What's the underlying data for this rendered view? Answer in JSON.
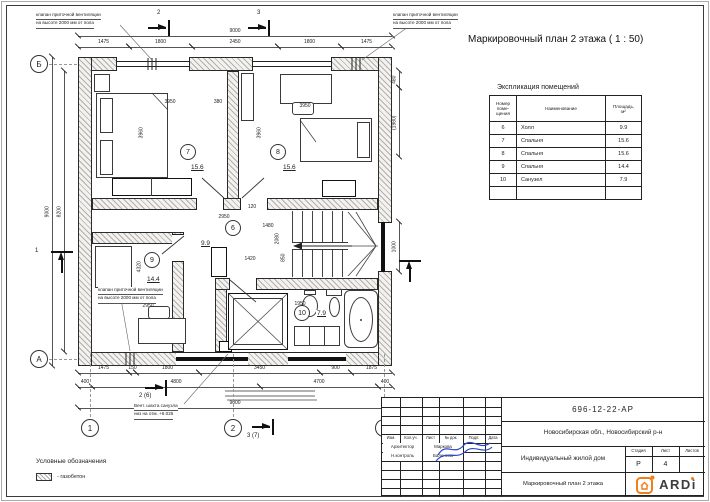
{
  "plan_title": "Маркировочный план 2 этажа ( 1 : 50)",
  "exp_table": {
    "title": "Экспликация помещений",
    "headers": [
      "Номер\nпоме-\nщения",
      "Наименование",
      "Площадь,\nм²"
    ],
    "rows": [
      [
        "6",
        "Холл",
        "9.9"
      ],
      [
        "7",
        "Спальня",
        "15.6"
      ],
      [
        "8",
        "Спальня",
        "15.6"
      ],
      [
        "9",
        "Спальня",
        "14.4"
      ],
      [
        "10",
        "Санузел",
        "7.9"
      ],
      [
        "",
        "",
        ""
      ]
    ]
  },
  "legend": {
    "title": "Условные обозначения",
    "item_label": "- газобетон"
  },
  "title_block": {
    "doc_number": "696-12-22-АР",
    "location": "Новосибирская обл., Новосибирский р-н",
    "project": "Индивидуальный жилой дом",
    "sheet_name": "Маркировочный план 2 этажа",
    "header_cells": [
      "Изм.",
      "Кол.уч.",
      "Лист",
      "№ док.",
      "Подп.",
      "Дата"
    ],
    "roles": [
      {
        "role": "Архитектор",
        "name": "Маркова"
      },
      {
        "role": "Н.контроль",
        "name": "Баленева"
      }
    ],
    "stage_label": "Стадия",
    "list_label": "Лист",
    "lists_label": "Листов",
    "stage": "Р",
    "list_no": "4",
    "lists_total": "",
    "brand": "ARDi",
    "brand_accent": "#ef7f1a"
  },
  "plan": {
    "rooms": [
      {
        "num": "6",
        "area": "9.9",
        "cx": 233,
        "cy": 228,
        "ax": 200,
        "ay": 240
      },
      {
        "num": "7",
        "area": "15.6",
        "cx": 188,
        "cy": 152,
        "ax": 190,
        "ay": 164
      },
      {
        "num": "8",
        "area": "15.6",
        "cx": 278,
        "cy": 152,
        "ax": 282,
        "ay": 164
      },
      {
        "num": "9",
        "area": "14.4",
        "cx": 152,
        "cy": 260,
        "ax": 146,
        "ay": 276
      },
      {
        "num": "10",
        "area": "7.9",
        "cx": 302,
        "cy": 313,
        "ax": 316,
        "ay": 310
      }
    ],
    "dims_h": [
      {
        "t": "1475",
        "x1": 78,
        "x2": 129,
        "y": 47
      },
      {
        "t": "1800",
        "x1": 129,
        "x2": 192,
        "y": 47
      },
      {
        "t": "2450",
        "x1": 192,
        "x2": 278,
        "y": 47
      },
      {
        "t": "1800",
        "x1": 278,
        "x2": 341,
        "y": 47
      },
      {
        "t": "1475",
        "x1": 341,
        "x2": 392,
        "y": 47
      },
      {
        "t": "9000",
        "x1": 78,
        "x2": 392,
        "y": 36
      },
      {
        "t": "1475",
        "x1": 78,
        "x2": 129,
        "y": 373
      },
      {
        "t": "150",
        "x1": 129,
        "x2": 136,
        "y": 373
      },
      {
        "t": "1800",
        "x1": 136,
        "x2": 199,
        "y": 373
      },
      {
        "t": "3450",
        "x1": 199,
        "x2": 320,
        "y": 373
      },
      {
        "t": "900",
        "x1": 320,
        "x2": 351,
        "y": 373
      },
      {
        "t": "1875",
        "x1": 351,
        "x2": 392,
        "y": 373
      },
      {
        "t": "400",
        "x1": 78,
        "x2": 92,
        "y": 387
      },
      {
        "t": "4800",
        "x1": 92,
        "x2": 260,
        "y": 387
      },
      {
        "t": "4700",
        "x1": 260,
        "x2": 378,
        "y": 387
      },
      {
        "t": "400",
        "x1": 378,
        "x2": 392,
        "y": 387
      },
      {
        "t": "9000",
        "x1": 78,
        "x2": 392,
        "y": 408
      }
    ],
    "dims_v": [
      {
        "t": "9000",
        "y1": 57,
        "y2": 366,
        "x": 52
      },
      {
        "t": "8200",
        "y1": 71,
        "y2": 352,
        "x": 64
      },
      {
        "t": "480",
        "y1": 71,
        "y2": 88,
        "x": 399
      },
      {
        "t": "(1980)",
        "y1": 88,
        "y2": 157,
        "x": 399
      },
      {
        "t": "1000",
        "y1": 222,
        "y2": 272,
        "x": 399
      }
    ],
    "labels": [
      {
        "t": "3950",
        "x": 170,
        "y": 100
      },
      {
        "t": "380",
        "x": 218,
        "y": 100
      },
      {
        "t": "3960",
        "x": 142,
        "y": 130,
        "v": 1
      },
      {
        "t": "3950",
        "x": 305,
        "y": 104
      },
      {
        "t": "3960",
        "x": 260,
        "y": 130,
        "v": 1
      },
      {
        "t": "2950",
        "x": 224,
        "y": 215
      },
      {
        "t": "120",
        "x": 252,
        "y": 205
      },
      {
        "t": "1480",
        "x": 268,
        "y": 224
      },
      {
        "t": "2080",
        "x": 278,
        "y": 236,
        "v": 1
      },
      {
        "t": "1420",
        "x": 250,
        "y": 257
      },
      {
        "t": "850",
        "x": 284,
        "y": 255,
        "v": 1
      },
      {
        "t": "2950",
        "x": 148,
        "y": 304
      },
      {
        "t": "4320",
        "x": 140,
        "y": 264,
        "v": 1
      },
      {
        "t": "1950",
        "x": 300,
        "y": 302
      }
    ],
    "axes_bottom": [
      {
        "l": "1",
        "x": 90
      },
      {
        "l": "2",
        "x": 233
      },
      {
        "l": "3",
        "x": 384
      }
    ],
    "axes_left": [
      {
        "l": "Б",
        "y": 64
      },
      {
        "l": "А",
        "y": 359
      }
    ],
    "markers": [
      {
        "l": "2",
        "x": 168,
        "y": 28,
        "dir": "right",
        "lx": 156,
        "ly": 10
      },
      {
        "l": "3",
        "x": 268,
        "y": 28,
        "dir": "right",
        "lx": 256,
        "ly": 10
      },
      {
        "l": "1",
        "x": 62,
        "y": 251,
        "dir": "up",
        "lx": 34,
        "ly": 248
      },
      {
        "l": "2 (6)",
        "x": 165,
        "y": 388,
        "dir": "right",
        "lx": 138,
        "ly": 393
      },
      {
        "l": "3 (7)",
        "x": 272,
        "y": 427,
        "dir": "right",
        "lx": 246,
        "ly": 433
      },
      {
        "l": "",
        "x": 410,
        "y": 260,
        "dir": "up",
        "lx": 0,
        "ly": 0
      }
    ],
    "notes": [
      {
        "lines": [
          "клапан приточной вентиляции",
          "на высоте 2000 мм от пола"
        ],
        "x": 36,
        "y": 12
      },
      {
        "lines": [
          "клапан приточной вентиляции",
          "на высоте 2000 мм от пола"
        ],
        "x": 393,
        "y": 12
      },
      {
        "lines": [
          "клапан приточной вентиляции",
          "на высоте 2000 мм от пола"
        ],
        "x": 98,
        "y": 287
      },
      {
        "lines": [
          "Вент. шахта санузла",
          "низ на отм. +6.025"
        ],
        "x": 134,
        "y": 403
      }
    ]
  }
}
